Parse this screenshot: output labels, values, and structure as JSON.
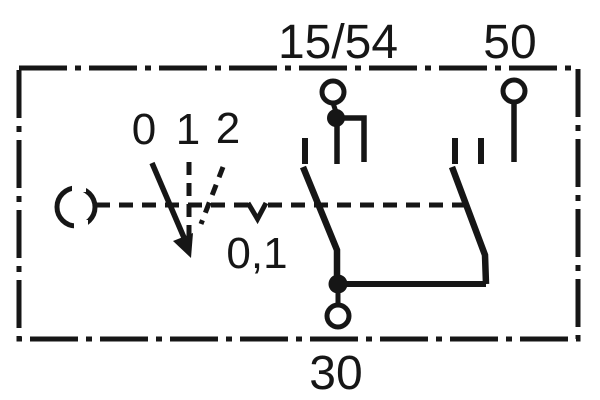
{
  "diagram": {
    "background_color": "#ffffff",
    "ink_color": "#161616",
    "terminals": {
      "top_left": "15/54",
      "top_right": "50",
      "bottom": "30"
    },
    "switch_positions": [
      "0",
      "1",
      "2"
    ],
    "detent_label": "0,1"
  }
}
